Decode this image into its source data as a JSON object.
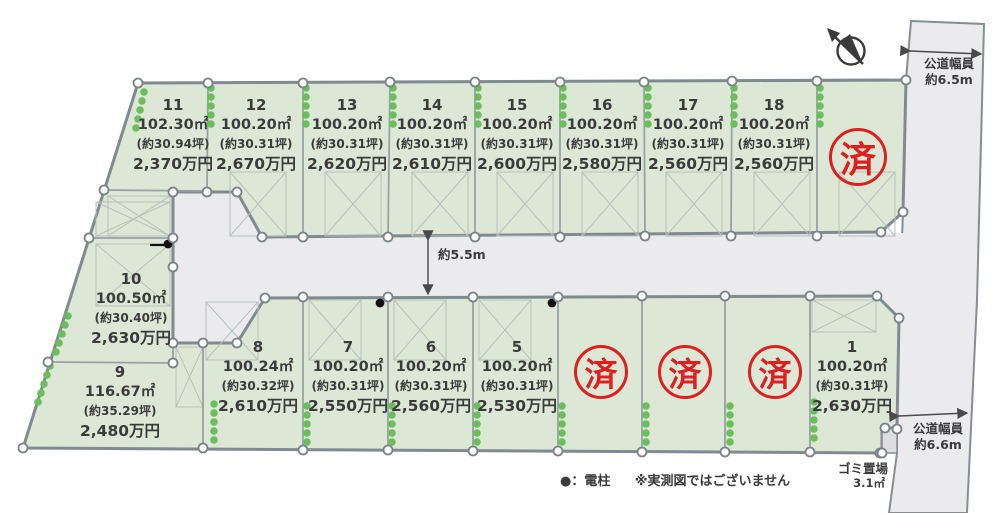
{
  "diagram": {
    "plots": [
      {
        "id": "11",
        "area": "102.30㎡",
        "tsubo": "(約30.94坪)",
        "price": "2,370万円"
      },
      {
        "id": "12",
        "area": "100.20㎡",
        "tsubo": "(約30.31坪)",
        "price": "2,670万円"
      },
      {
        "id": "13",
        "area": "100.20㎡",
        "tsubo": "(約30.31坪)",
        "price": "2,620万円"
      },
      {
        "id": "14",
        "area": "100.20㎡",
        "tsubo": "(約30.31坪)",
        "price": "2,610万円"
      },
      {
        "id": "15",
        "area": "100.20㎡",
        "tsubo": "(約30.31坪)",
        "price": "2,600万円"
      },
      {
        "id": "16",
        "area": "100.20㎡",
        "tsubo": "(約30.31坪)",
        "price": "2,580万円"
      },
      {
        "id": "17",
        "area": "100.20㎡",
        "tsubo": "(約30.31坪)",
        "price": "2,560万円"
      },
      {
        "id": "18",
        "area": "100.20㎡",
        "tsubo": "(約30.31坪)",
        "price": "2,560万円"
      },
      {
        "id": "10",
        "area": "100.50㎡",
        "tsubo": "(約30.40坪)",
        "price": "2,630万円"
      },
      {
        "id": "9",
        "area": "116.67㎡",
        "tsubo": "(約35.29坪)",
        "price": "2,480万円"
      },
      {
        "id": "8",
        "area": "100.24㎡",
        "tsubo": "(約30.32坪)",
        "price": "2,610万円"
      },
      {
        "id": "7",
        "area": "100.20㎡",
        "tsubo": "(約30.31坪)",
        "price": "2,550万円"
      },
      {
        "id": "6",
        "area": "100.20㎡",
        "tsubo": "(約30.31坪)",
        "price": "2,560万円"
      },
      {
        "id": "5",
        "area": "100.20㎡",
        "tsubo": "(約30.31坪)",
        "price": "2,530万円"
      },
      {
        "id": "1",
        "area": "100.20㎡",
        "tsubo": "(約30.31坪)",
        "price": "2,630万円"
      }
    ],
    "sold_stamps": [
      "済",
      "済",
      "済",
      "済"
    ],
    "internal_road_width": "約5.5m",
    "right_road_top_line1": "公道幅員",
    "right_road_top_line2": "約6.5m",
    "right_road_bottom_line1": "公道幅員",
    "right_road_bottom_line2": "約6.6m",
    "garbage_line1": "ゴミ置場",
    "garbage_line2": "3.1㎡",
    "legend_pole": "●：電柱",
    "legend_note": "※実測図ではございません",
    "icons": {
      "north_compass": "north-arrow-icon",
      "survey_point": "white-circle-marker",
      "utility_pole": "black-dot-marker",
      "shrub": "green-shrub-dots"
    },
    "colors": {
      "lot_fill": "#dce8d5",
      "road_fill": "#ebebed",
      "boundary": "#7f8a91",
      "sold_red": "#dd1f1f",
      "text": "#3b3b3d",
      "shrub_green": "#6abf5c"
    }
  }
}
